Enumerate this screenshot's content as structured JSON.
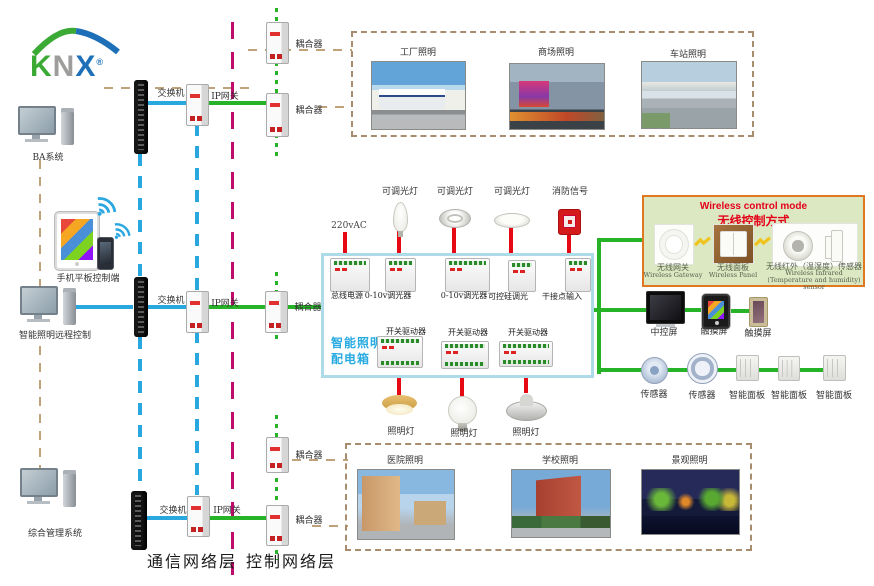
{
  "logo": {
    "k": "K",
    "n": "N",
    "x": "X",
    "reg": "®"
  },
  "left": {
    "items": [
      {
        "label": "BA系统"
      },
      {
        "label": "手机平板控制端"
      },
      {
        "label": "智能照明远程控制"
      },
      {
        "label": "综合管理系统"
      }
    ]
  },
  "network": {
    "rows": [
      {
        "switch": "交换机",
        "gateway": "IP网关"
      },
      {
        "switch": "交换机",
        "gateway": "IP网关"
      },
      {
        "switch": "交换机",
        "gateway": "IP网关"
      }
    ],
    "couplers": [
      "耦合器",
      "耦合器",
      "耦合器",
      "耦合器",
      "耦合器"
    ]
  },
  "layers": {
    "comm": "通信网络层",
    "ctrl": "控制网络层"
  },
  "zones_top": {
    "items": [
      {
        "label": "工厂照明"
      },
      {
        "label": "商场照明"
      },
      {
        "label": "车站照明"
      }
    ]
  },
  "zones_bottom": {
    "items": [
      {
        "label": "医院照明"
      },
      {
        "label": "学校照明"
      },
      {
        "label": "景观照明"
      }
    ]
  },
  "cabinet": {
    "name_line1": "智能照明",
    "name_line2": "配电箱",
    "power": "220vAC",
    "row1_modules": [
      "总线电源",
      "0-10v调光器",
      "0-10v调光器",
      "可控硅调光",
      "干接点输入"
    ],
    "row1_loads": [
      "可调光灯",
      "可调光灯",
      "可调光灯",
      "消防信号"
    ],
    "row2_modules": [
      "开关驱动器",
      "开关驱动器",
      "开关驱动器"
    ],
    "row2_loads": [
      "照明灯",
      "照明灯",
      "照明灯"
    ]
  },
  "wireless": {
    "title_en": "Wireless control mode",
    "title_cn": "无线控制方式",
    "devices": [
      {
        "cn": "无线网关",
        "en": "Wireless Gateway"
      },
      {
        "cn": "无线面板",
        "en": "Wireless Panel"
      },
      {
        "cn": "无线红外（温湿度）传感器",
        "en": "Wireless Infrared (Temperature and humidity) sensor"
      }
    ]
  },
  "control": {
    "screens": [
      {
        "label": "中控屏"
      },
      {
        "label": "触摸屏"
      },
      {
        "label": "触摸屏"
      }
    ],
    "row2": [
      {
        "label": "传感器"
      },
      {
        "label": "传感器"
      },
      {
        "label": "智能面板"
      },
      {
        "label": "智能面板"
      },
      {
        "label": "智能面板"
      }
    ]
  },
  "colors": {
    "bus_green": "#27b327",
    "lan_blue": "#29a8e0",
    "power_red": "#e60914",
    "divider_magenta": "#bf0a6e",
    "link_tan": "#bfa27a",
    "cabinet_accent": "#29abe2",
    "wireless_border": "#e07820",
    "wireless_title": "#e50019",
    "knx_green": "#3aaa35",
    "knx_gray": "#9d9d9c",
    "knx_blue": "#1d70b7"
  }
}
